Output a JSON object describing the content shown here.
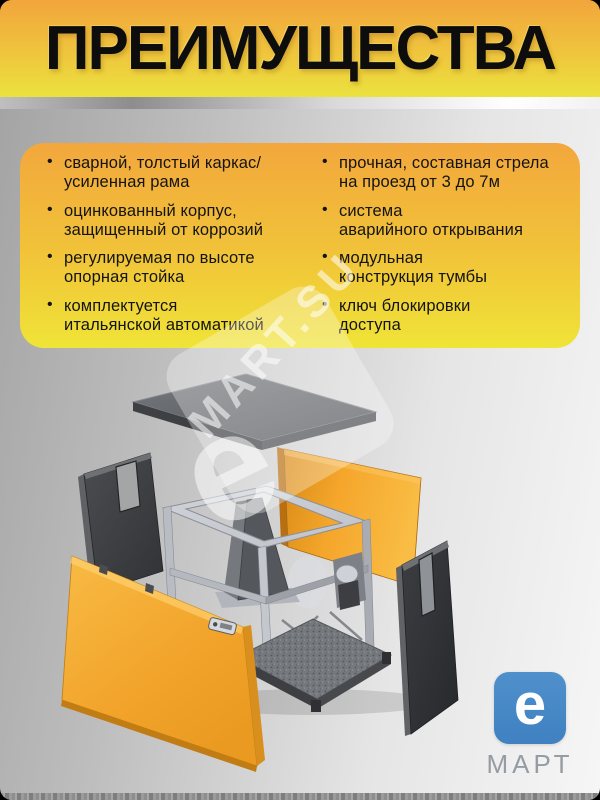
{
  "header": {
    "title": "ПРЕИМУЩЕСТВА"
  },
  "advantages": {
    "bullet_char": "•",
    "left": [
      "сварной, толстый каркас/\nусиленная рама",
      "оцинкованный корпус,\nзащищенный от коррозий",
      "регулируемая по высоте\nопорная стойка",
      "комплектуется\nитальянской автоматикой"
    ],
    "right": [
      "прочная, составная стрела\nна проезд от 3 до 7м",
      "система\nаварийного открывания",
      "модульная\nконструкция тумбы",
      "ключ блокировки\nдоступа"
    ]
  },
  "diagram": {
    "description_icon": "exploded-view-barrier-cabinet",
    "parts": [
      "top-lid",
      "left-rear-panel",
      "rear-orange-panel",
      "frame",
      "motor-unit",
      "base-plate",
      "right-side-panel",
      "front-orange-door",
      "door-lock-plate"
    ]
  },
  "watermark": {
    "brand_text": "MART.SU",
    "letter": "е"
  },
  "logo": {
    "letter": "е",
    "name": "МАРТ"
  },
  "colors": {
    "header_top": "#F2A53C",
    "header_bottom": "#EBE23E",
    "card_top": "#F2A73C",
    "card_bottom": "#F0E437",
    "bullet_text": "#141414",
    "panel_orange": "#F5A62B",
    "panel_orange_dark": "#D78A15",
    "door_orange": "#F2A42B",
    "panel_dark": "#3C3E42",
    "frame_gray": "#BFC3C9",
    "logo_blue": "#3F81C1",
    "logo_text": "#959CA3"
  }
}
